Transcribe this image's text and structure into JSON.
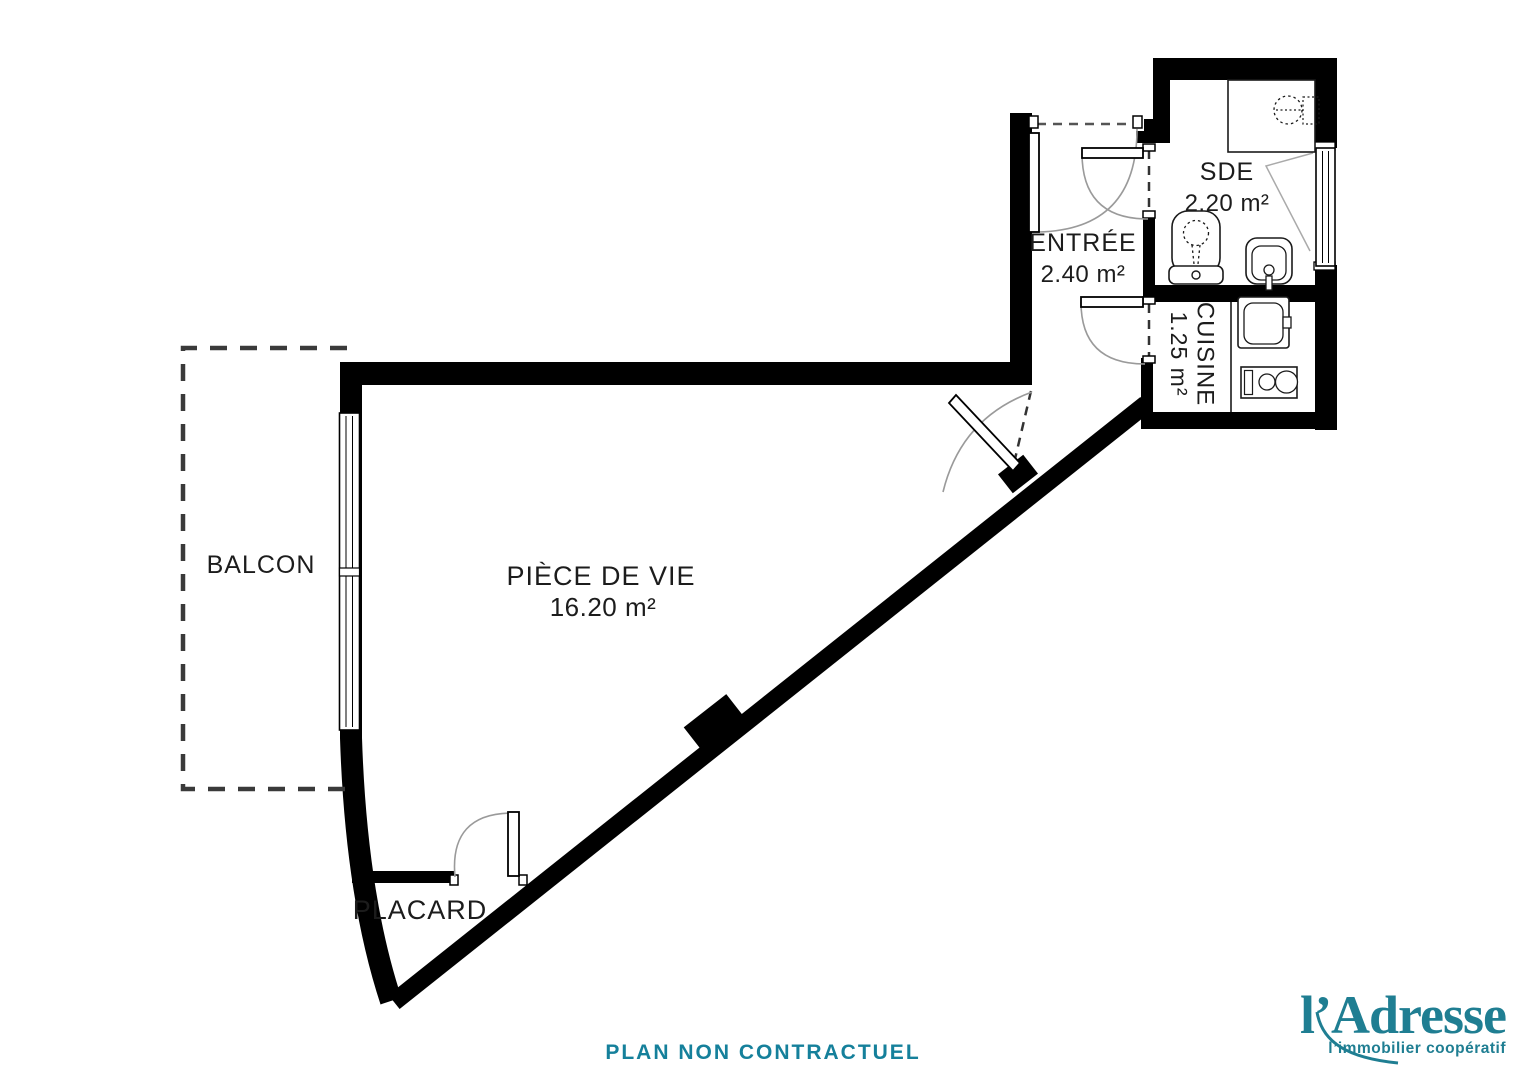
{
  "plan": {
    "balcon": {
      "name": "BALCON"
    },
    "piece_de_vie": {
      "name": "PIÈCE DE VIE",
      "area": "16.20 m²"
    },
    "placard": {
      "name": "PLACARD"
    },
    "entree": {
      "name": "ENTRÉE",
      "area": "2.40 m²"
    },
    "sde": {
      "name": "SDE",
      "area": "2.20 m²"
    },
    "cuisine": {
      "name": "CUISINE",
      "area": "1.25 m²"
    },
    "disclaimer": "PLAN NON CONTRACTUEL"
  },
  "branding": {
    "logo": "l’Adresse",
    "tagline": "l’immobilier coopératif",
    "accent_color": "#1F7E92",
    "disclaimer_color": "#15809B"
  },
  "colors": {
    "walls": "#000000",
    "background": "#ffffff",
    "dashed_outline": "#3a3a3a"
  }
}
